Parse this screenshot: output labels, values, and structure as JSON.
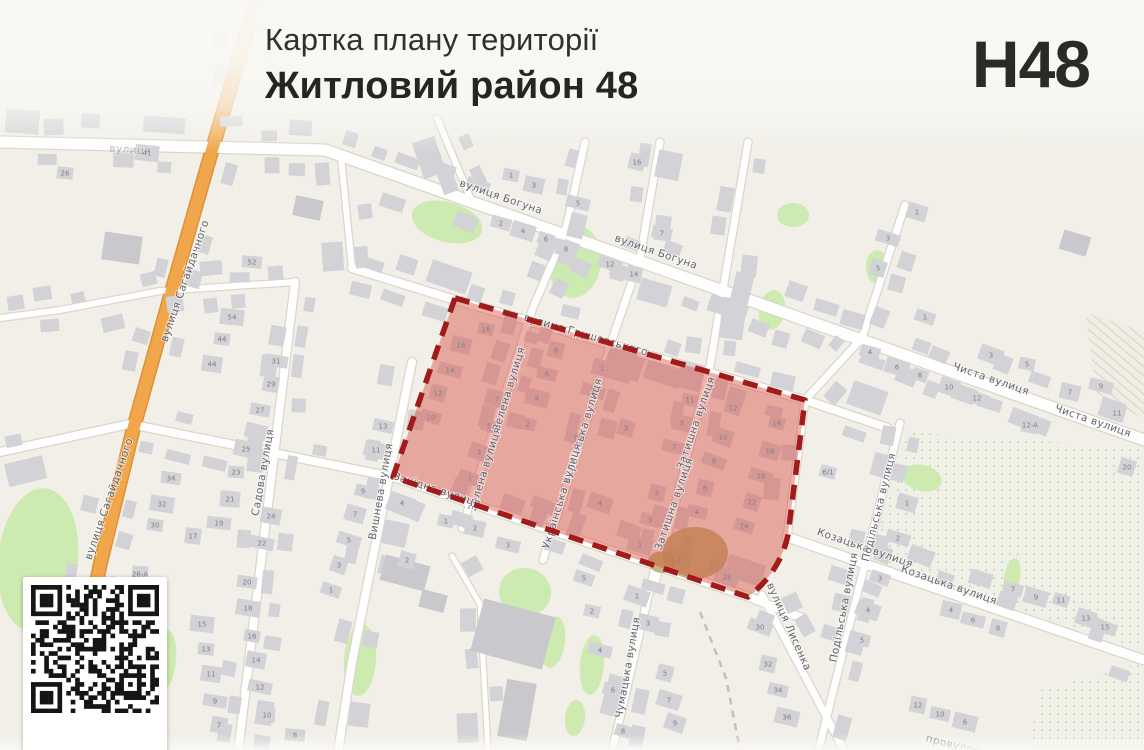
{
  "header": {
    "subtitle": "Картка плану території",
    "title": "Житловий район 48",
    "code": "H48"
  },
  "map": {
    "colors": {
      "highlight_fill": "#d94f44",
      "highlight_border": "#a21b1b",
      "road_orange": "#f2a64b",
      "road_orange_casing": "#dd9136",
      "green": "#cdeab0",
      "scrub": "#b3a55e",
      "building": "#d3d2d6",
      "building_large": "#c9c8cd",
      "label": "#62626b",
      "number": "#7c8287"
    },
    "street_labels": [
      {
        "t": "вулиця Богуна",
        "x": 500,
        "y": 200,
        "r": 19
      },
      {
        "t": "вулиця Богуна",
        "x": 655,
        "y": 255,
        "r": 19
      },
      {
        "t": "вулиця Грушевського",
        "x": 585,
        "y": 338,
        "r": 16
      },
      {
        "t": "Зелена вулиця",
        "x": 512,
        "y": 390,
        "r": -73
      },
      {
        "t": "Зелена вулиця",
        "x": 488,
        "y": 470,
        "r": -73
      },
      {
        "t": "Українська вулиця",
        "x": 586,
        "y": 432,
        "r": -73
      },
      {
        "t": "Українська вулиця",
        "x": 565,
        "y": 497,
        "r": -73
      },
      {
        "t": "Затишна вулиця",
        "x": 699,
        "y": 424,
        "r": -71
      },
      {
        "t": "Затишна вулиця",
        "x": 677,
        "y": 505,
        "r": -71
      },
      {
        "t": "Західна вулиця",
        "x": 436,
        "y": 493,
        "r": 18
      },
      {
        "t": "Вишнева вулиця",
        "x": 384,
        "y": 492,
        "r": -80
      },
      {
        "t": "Садова вулиця",
        "x": 266,
        "y": 473,
        "r": -80
      },
      {
        "t": "вулиця Сагайдачного",
        "x": 188,
        "y": 282,
        "r": -71
      },
      {
        "t": "вулиця Сагайдачного",
        "x": 112,
        "y": 500,
        "r": -71
      },
      {
        "t": "Козацька вулиця",
        "x": 864,
        "y": 551,
        "r": 19
      },
      {
        "t": "Козацька вулиця",
        "x": 948,
        "y": 588,
        "r": 19
      },
      {
        "t": "Подільська вулиця",
        "x": 882,
        "y": 508,
        "r": -76
      },
      {
        "t": "Подільська вулиця",
        "x": 847,
        "y": 608,
        "r": -79
      },
      {
        "t": "Чиста вулиця",
        "x": 990,
        "y": 382,
        "r": 19
      },
      {
        "t": "Чиста вулиця",
        "x": 1092,
        "y": 424,
        "r": 19
      },
      {
        "t": "Чумацька вулиця",
        "x": 631,
        "y": 668,
        "r": -80
      },
      {
        "t": "вулиця Лисенка",
        "x": 786,
        "y": 628,
        "r": 66
      },
      {
        "t": "вулиця",
        "x": 130,
        "y": 153,
        "r": 4,
        "o": 0.45
      },
      {
        "t": "Лісова вулиця",
        "x": 1082,
        "y": 8,
        "r": 10,
        "o": 0.3
      },
      {
        "t": "провулок",
        "x": 952,
        "y": 748,
        "r": 14,
        "o": 0.8
      }
    ],
    "house_numbers": [
      [
        486,
        329,
        "18"
      ],
      [
        461,
        345,
        "16"
      ],
      [
        450,
        370,
        "14"
      ],
      [
        438,
        393,
        "12"
      ],
      [
        431,
        417,
        "10"
      ],
      [
        497,
        399,
        "7"
      ],
      [
        489,
        426,
        "5"
      ],
      [
        479,
        452,
        "3"
      ],
      [
        470,
        478,
        "1"
      ],
      [
        556,
        350,
        "8"
      ],
      [
        547,
        374,
        "6"
      ],
      [
        537,
        398,
        "4"
      ],
      [
        528,
        424,
        "2"
      ],
      [
        602,
        368,
        "1"
      ],
      [
        593,
        391,
        "2"
      ],
      [
        626,
        428,
        "3"
      ],
      [
        575,
        438,
        "7"
      ],
      [
        600,
        503,
        "4"
      ],
      [
        690,
        400,
        "11"
      ],
      [
        682,
        423,
        "9"
      ],
      [
        674,
        447,
        "7"
      ],
      [
        657,
        493,
        "5"
      ],
      [
        650,
        520,
        "3"
      ],
      [
        640,
        545,
        "1"
      ],
      [
        733,
        408,
        "12"
      ],
      [
        723,
        437,
        "10"
      ],
      [
        714,
        461,
        "8"
      ],
      [
        705,
        488,
        "6"
      ],
      [
        697,
        512,
        "4"
      ],
      [
        679,
        559,
        "2"
      ],
      [
        777,
        423,
        "16"
      ],
      [
        770,
        451,
        "18"
      ],
      [
        761,
        476,
        "20"
      ],
      [
        752,
        502,
        "22"
      ],
      [
        744,
        526,
        "24"
      ],
      [
        727,
        577,
        "28"
      ],
      [
        511,
        175,
        "1"
      ],
      [
        534,
        185,
        "3"
      ],
      [
        578,
        203,
        "5"
      ],
      [
        637,
        162,
        "16"
      ],
      [
        501,
        223,
        "2"
      ],
      [
        523,
        231,
        "4"
      ],
      [
        546,
        239,
        "6"
      ],
      [
        566,
        249,
        "8"
      ],
      [
        610,
        264,
        "12"
      ],
      [
        634,
        274,
        "14"
      ],
      [
        662,
        233,
        "7"
      ],
      [
        147,
        153,
        "41"
      ],
      [
        65,
        173,
        "26"
      ],
      [
        917,
        212,
        "1"
      ],
      [
        888,
        238,
        "3"
      ],
      [
        878,
        268,
        "5"
      ],
      [
        925,
        317,
        "1"
      ],
      [
        991,
        355,
        "3"
      ],
      [
        1027,
        364,
        "5"
      ],
      [
        1070,
        392,
        "7"
      ],
      [
        1101,
        386,
        "9"
      ],
      [
        1117,
        413,
        "11"
      ],
      [
        870,
        352,
        "4"
      ],
      [
        897,
        367,
        "6"
      ],
      [
        920,
        375,
        "8"
      ],
      [
        949,
        387,
        "10"
      ],
      [
        977,
        398,
        "12"
      ],
      [
        1030,
        425,
        "12-А"
      ],
      [
        252,
        262,
        "52"
      ],
      [
        232,
        317,
        "54"
      ],
      [
        222,
        339,
        "44"
      ],
      [
        212,
        364,
        "44"
      ],
      [
        276,
        361,
        "31"
      ],
      [
        271,
        384,
        "29"
      ],
      [
        260,
        410,
        "27"
      ],
      [
        246,
        449,
        "25"
      ],
      [
        236,
        472,
        "23"
      ],
      [
        230,
        499,
        "21"
      ],
      [
        219,
        523,
        "19"
      ],
      [
        193,
        536,
        "17"
      ],
      [
        171,
        478,
        "34"
      ],
      [
        162,
        504,
        "32"
      ],
      [
        155,
        525,
        "30"
      ],
      [
        271,
        516,
        "24"
      ],
      [
        262,
        543,
        "22"
      ],
      [
        140,
        574,
        "26-А"
      ],
      [
        383,
        426,
        "13"
      ],
      [
        376,
        450,
        "11"
      ],
      [
        363,
        491,
        "9"
      ],
      [
        355,
        514,
        "7"
      ],
      [
        349,
        540,
        "5"
      ],
      [
        339,
        565,
        "3"
      ],
      [
        331,
        590,
        "1"
      ],
      [
        402,
        503,
        "4"
      ],
      [
        446,
        521,
        "1"
      ],
      [
        475,
        528,
        "2"
      ],
      [
        508,
        545,
        "3"
      ],
      [
        407,
        560,
        "2"
      ],
      [
        247,
        582,
        "20"
      ],
      [
        248,
        608,
        "18"
      ],
      [
        252,
        636,
        "16"
      ],
      [
        256,
        660,
        "14"
      ],
      [
        260,
        687,
        "12"
      ],
      [
        267,
        715,
        "10"
      ],
      [
        295,
        735,
        "8"
      ],
      [
        202,
        624,
        "15"
      ],
      [
        206,
        649,
        "13"
      ],
      [
        211,
        674,
        "11"
      ],
      [
        215,
        701,
        "9"
      ],
      [
        219,
        725,
        "7"
      ],
      [
        584,
        578,
        "5"
      ],
      [
        637,
        596,
        "1"
      ],
      [
        592,
        611,
        "2"
      ],
      [
        648,
        623,
        "3"
      ],
      [
        600,
        650,
        "4"
      ],
      [
        665,
        673,
        "5"
      ],
      [
        613,
        690,
        "6"
      ],
      [
        669,
        700,
        "7"
      ],
      [
        623,
        731,
        "8"
      ],
      [
        675,
        723,
        "9"
      ],
      [
        760,
        627,
        "30"
      ],
      [
        768,
        664,
        "32"
      ],
      [
        778,
        690,
        "34"
      ],
      [
        787,
        717,
        "36"
      ],
      [
        828,
        472,
        "6/1"
      ],
      [
        907,
        503,
        "1"
      ],
      [
        898,
        538,
        "2"
      ],
      [
        1127,
        467,
        "20"
      ],
      [
        880,
        578,
        "3"
      ],
      [
        868,
        610,
        "4"
      ],
      [
        862,
        640,
        "5"
      ],
      [
        951,
        610,
        "4"
      ],
      [
        973,
        620,
        "6"
      ],
      [
        998,
        628,
        "8"
      ],
      [
        1013,
        589,
        "7"
      ],
      [
        1036,
        597,
        "9"
      ],
      [
        1061,
        600,
        "11"
      ],
      [
        1086,
        618,
        "13"
      ],
      [
        1105,
        627,
        "15"
      ],
      [
        918,
        705,
        "12"
      ],
      [
        940,
        714,
        "10"
      ],
      [
        965,
        722,
        "6"
      ]
    ]
  }
}
